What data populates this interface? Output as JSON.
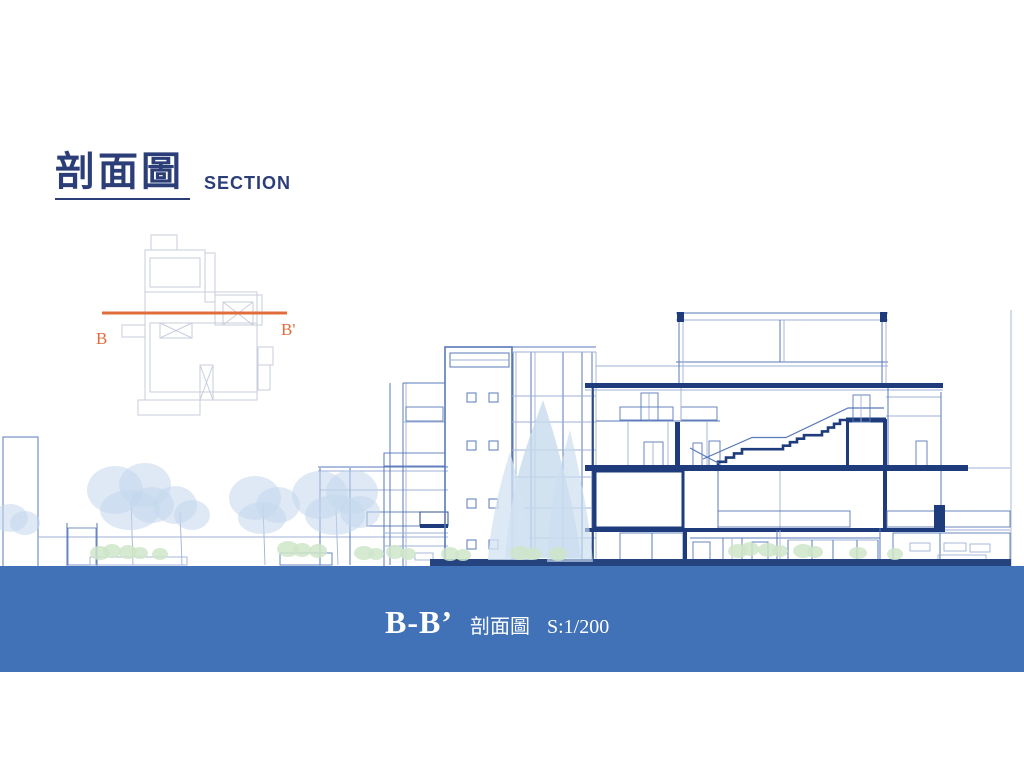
{
  "title": {
    "text": "剖面圖",
    "subtitle": "SECTION",
    "color": "#2C3E78"
  },
  "key_plan": {
    "label_b": "B",
    "label_b_prime": "B'",
    "section_line_color": "#E06C3C",
    "plan_line_color": "#C9CEDE"
  },
  "caption": {
    "section_label": "B-B’",
    "drawing_name": "剖面圖",
    "scale": "S:1/200",
    "band_color": "#4171B6",
    "text_color": "#FFFFFF"
  },
  "drawing": {
    "line_color": "#5878B8",
    "light_line_color": "#9FB2D6",
    "cut_color": "#1E3C7C",
    "tree_color": "#C5D9ED",
    "shrub_color": "#CFE5C9"
  }
}
